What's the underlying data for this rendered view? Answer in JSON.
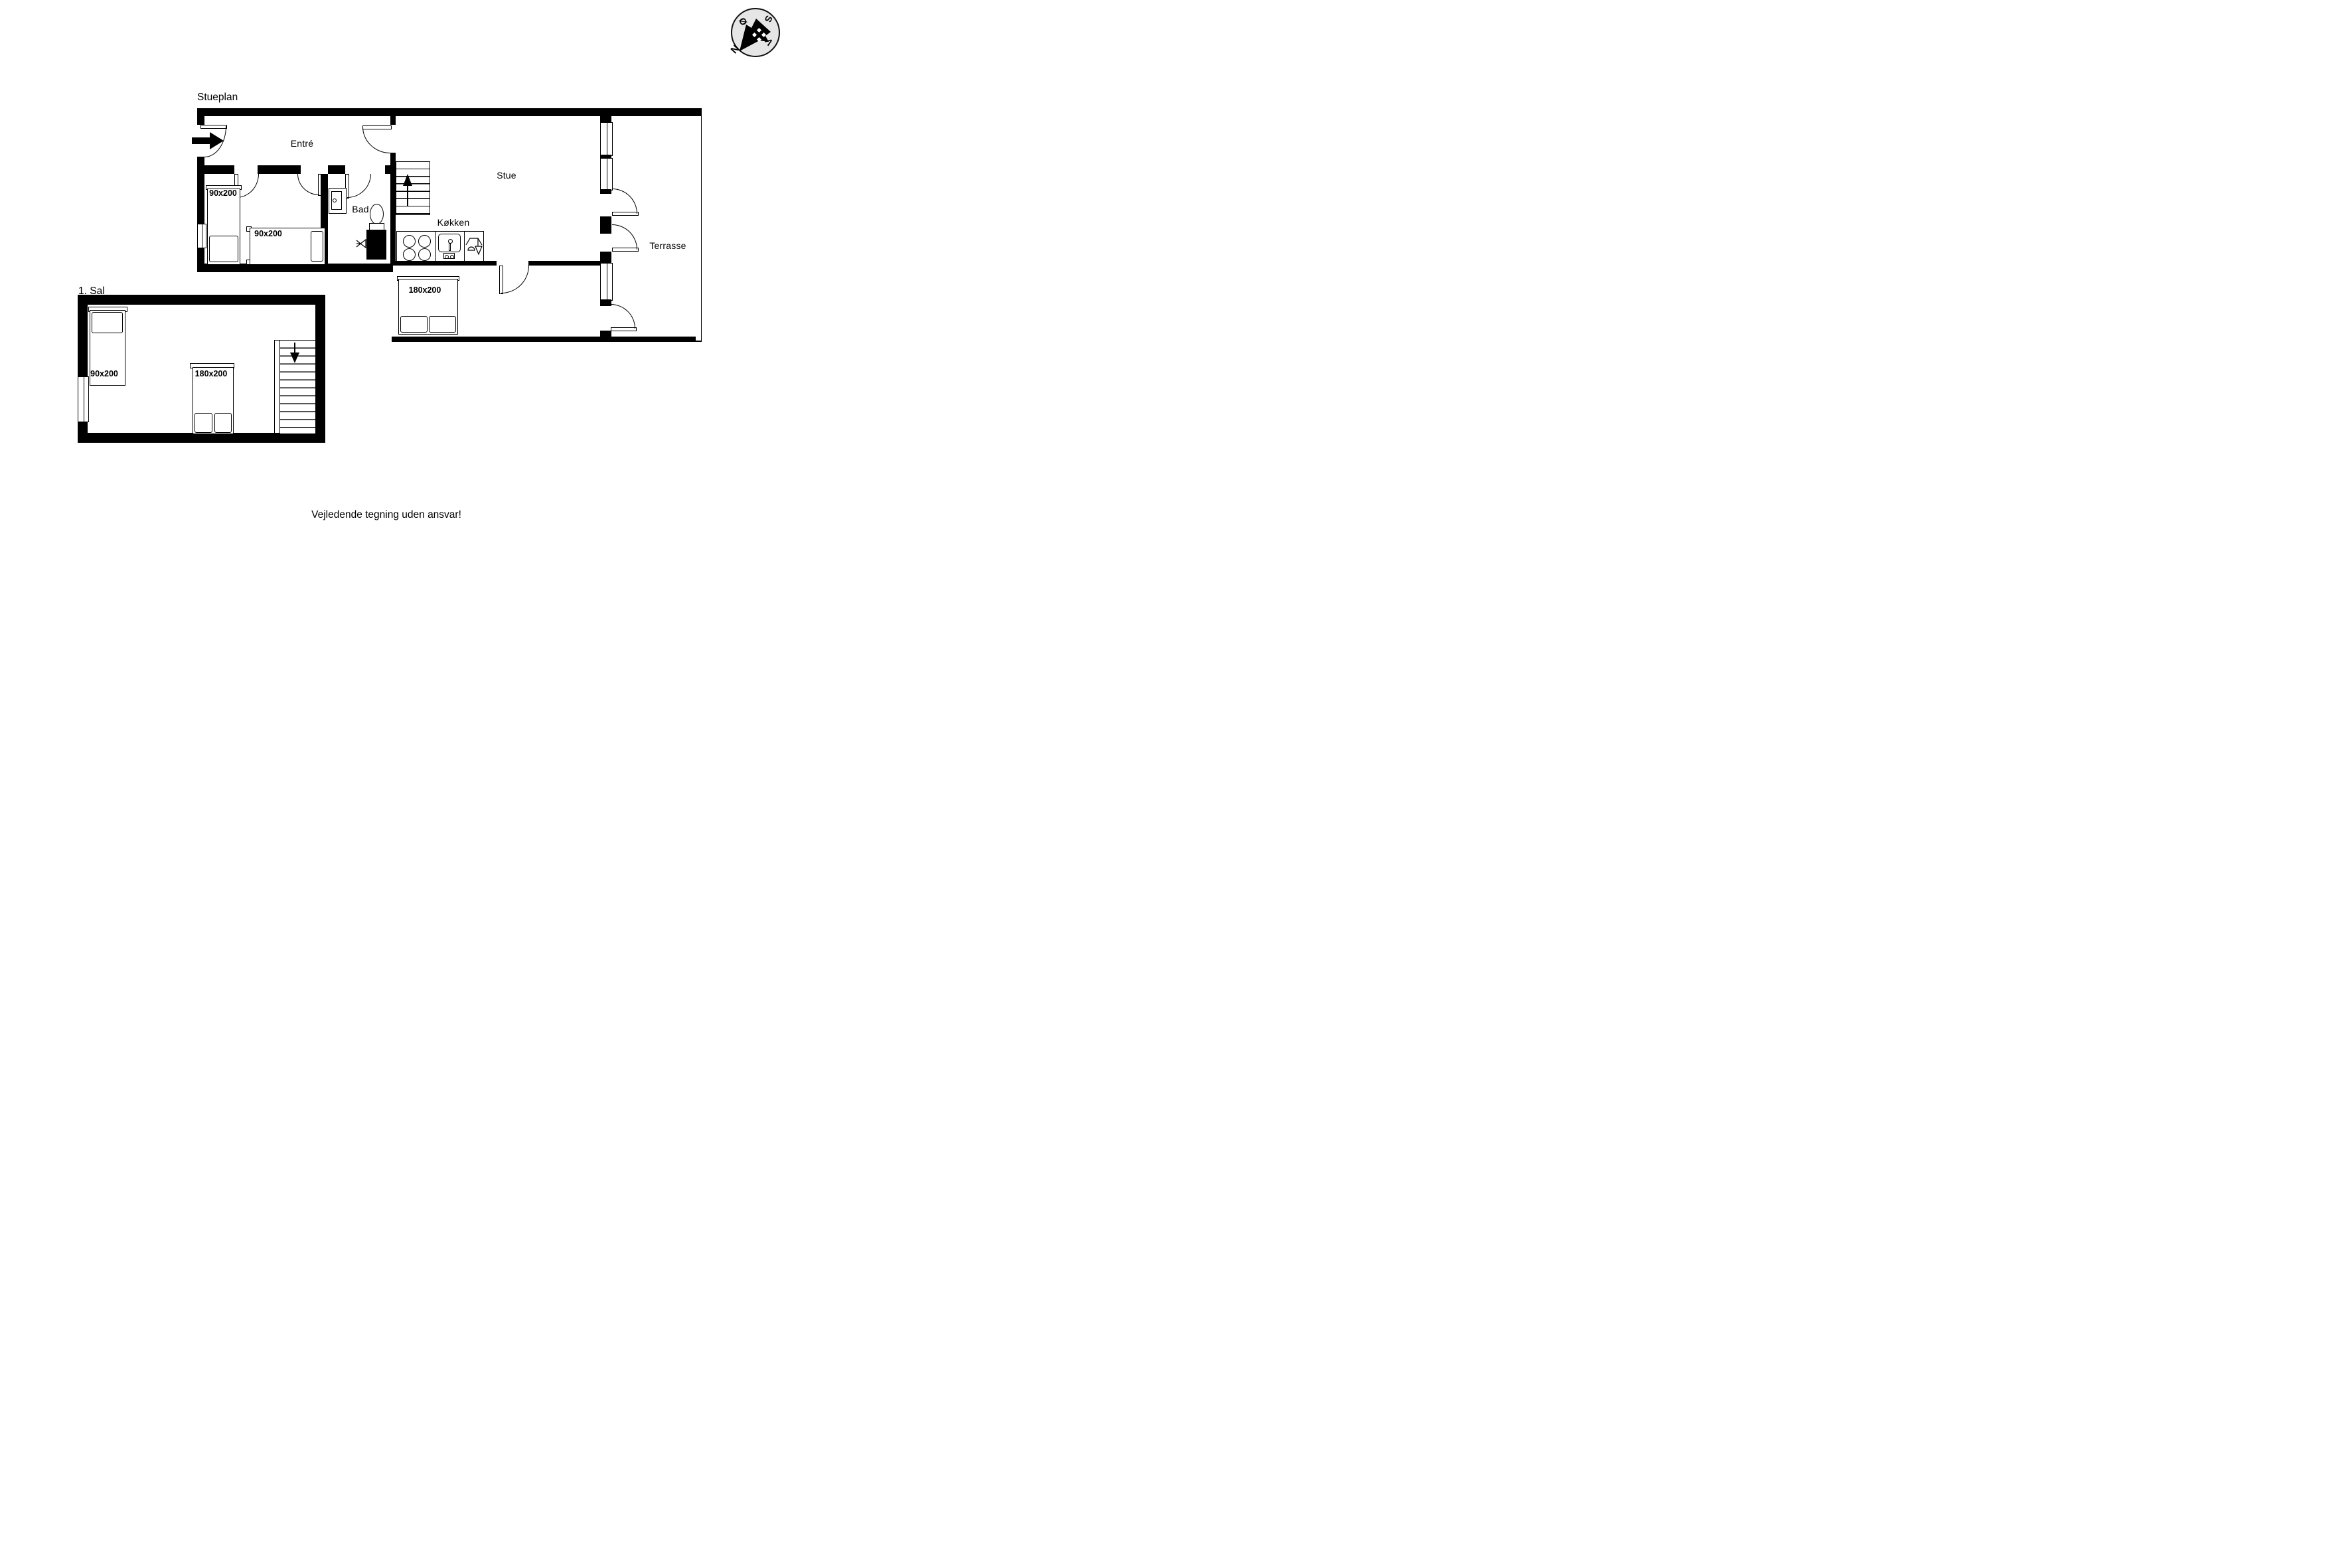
{
  "page": {
    "disclaimer": "Vejledende tegning uden ansvar!"
  },
  "compass": {
    "north": "N",
    "south": "S",
    "east": "Ø",
    "west": "V"
  },
  "ground_floor": {
    "title": "Stueplan",
    "rooms": {
      "entre": "Entré",
      "bad": "Bad",
      "stue": "Stue",
      "kokken": "Køkken",
      "terrasse": "Terrasse"
    },
    "beds": [
      {
        "label": "90x200"
      },
      {
        "label": "90x200"
      },
      {
        "label": "180x200"
      }
    ]
  },
  "first_floor": {
    "title": "1. Sal",
    "beds": [
      {
        "label": "90x200"
      },
      {
        "label": "180x200"
      }
    ]
  }
}
